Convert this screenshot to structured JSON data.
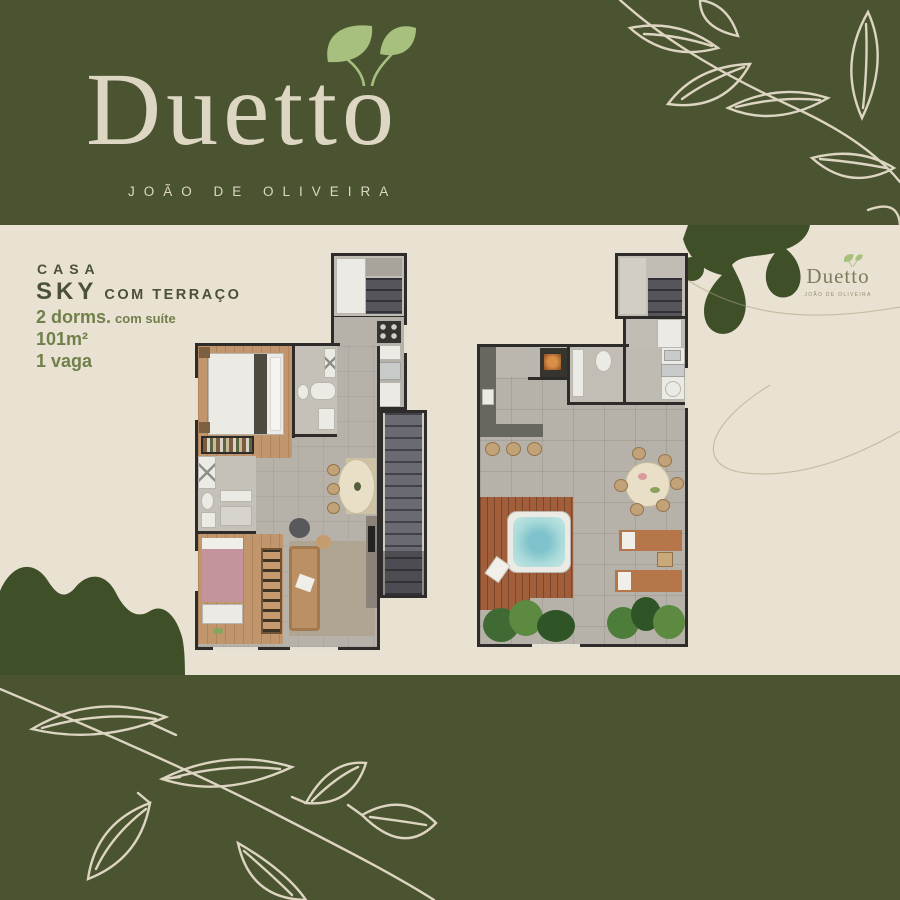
{
  "brand": {
    "name": "Duetto",
    "tagline": "JOÃO DE OLIVEIRA",
    "colors": {
      "band_green": "#4a5431",
      "cream": "#e9e2d2",
      "logo_cream": "#ddd6c3",
      "leaf_green": "#a7c07d",
      "blob_green": "#3f4f27",
      "heading_text": "#4a5138",
      "accent_text": "#70804a",
      "line_art": "#ddd5c2"
    }
  },
  "unit": {
    "category": "CASA",
    "name": "SKY",
    "variant": "COM TERRAÇO",
    "specs": [
      {
        "value": "2 dorms.",
        "note": "com suíte"
      },
      {
        "value": "101m²",
        "note": ""
      },
      {
        "value": "1 vaga",
        "note": ""
      }
    ]
  },
  "art": {
    "icons": [
      "brand-leaves-icon",
      "branch-art-top-right",
      "branch-art-bottom",
      "blob-art-right",
      "blob-art-left",
      "curve-line-art",
      "watermark-leaves-icon"
    ]
  }
}
